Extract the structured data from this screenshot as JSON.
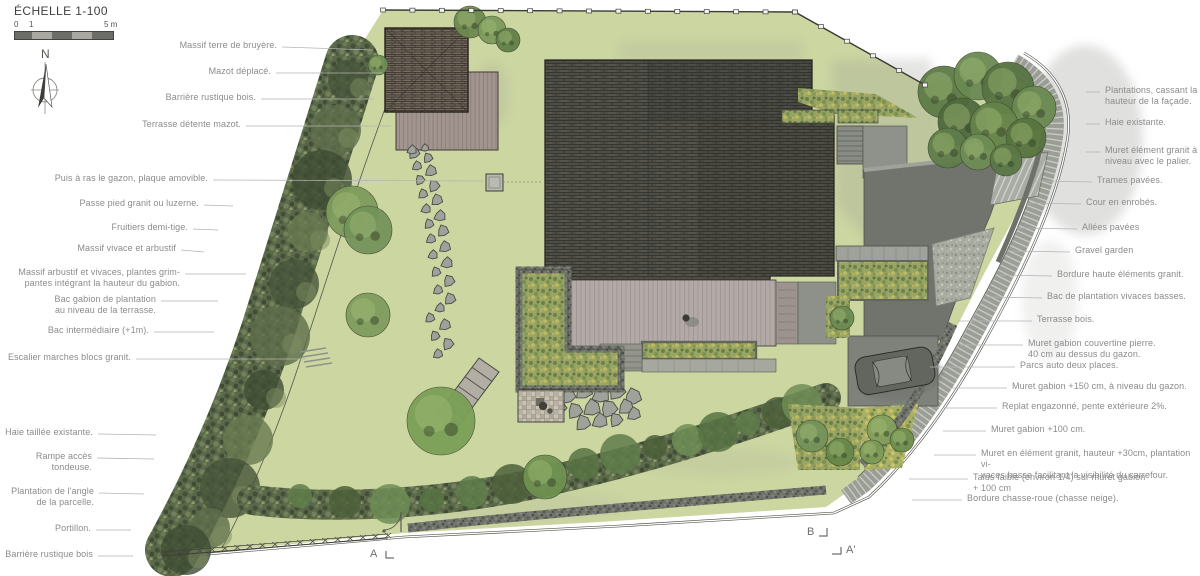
{
  "title_block": {
    "scale_label": "ÉCHELLE 1-100",
    "tick_0": "0",
    "tick_1": "1",
    "tick_5": "5 m",
    "north_label": "N"
  },
  "colors": {
    "lawn": "#ccd6a1",
    "hedge_green": "#5b684b",
    "roof_dark": "#4e4e47",
    "deck_wood": "#b3aaa8",
    "mazot_deck": "#a29590",
    "asphalt_court": "#70746d",
    "paving_gray": "#9b9e96",
    "gabion_gray": "#70746c",
    "label_text": "#8b8b8b",
    "leader_line": "#b3b3b3"
  },
  "annotations": {
    "left": [
      {
        "lines": [
          "Massif terre de bruyère."
        ],
        "x": 277,
        "y": 47,
        "tx": 373,
        "ty": 50
      },
      {
        "lines": [
          "Mazot déplacé."
        ],
        "x": 271,
        "y": 73,
        "tx": 382,
        "ty": 73
      },
      {
        "lines": [
          "Barrière rustique bois."
        ],
        "x": 256,
        "y": 99,
        "tx": 374,
        "ty": 99
      },
      {
        "lines": [
          "Terrasse détente mazot."
        ],
        "x": 241,
        "y": 126,
        "tx": 391,
        "ty": 126
      },
      {
        "lines": [
          "Puis à ras le gazon, plaque amovible."
        ],
        "x": 208,
        "y": 180,
        "tx": 483,
        "ty": 181
      },
      {
        "lines": [
          "Passe pied granit ou luzerne."
        ],
        "x": 199,
        "y": 205,
        "tx": 233,
        "ty": 206
      },
      {
        "lines": [
          "Fruitiers demi-tige."
        ],
        "x": 188,
        "y": 229,
        "tx": 218,
        "ty": 230
      },
      {
        "lines": [
          "Massif vivace et arbustif"
        ],
        "x": 176,
        "y": 250,
        "tx": 204,
        "ty": 252
      },
      {
        "lines": [
          "Massif arbustif et vivaces, plantes grim-",
          "pantes intégrant la hauteur du gabion."
        ],
        "x": 180,
        "y": 274,
        "tx": 246,
        "ty": 274
      },
      {
        "lines": [
          "Bac gabion de plantation",
          "au niveau de la terrasse."
        ],
        "x": 156,
        "y": 301,
        "tx": 218,
        "ty": 301
      },
      {
        "lines": [
          "Bac intermédiaire (+1m)."
        ],
        "x": 149,
        "y": 332,
        "tx": 214,
        "ty": 332
      },
      {
        "lines": [
          "Escalier marches blocs granit."
        ],
        "x": 131,
        "y": 359,
        "tx": 306,
        "ty": 359
      },
      {
        "lines": [
          "Haie taillée existante."
        ],
        "x": 93,
        "y": 434,
        "tx": 156,
        "ty": 435
      },
      {
        "lines": [
          "Rampe accès tondeuse."
        ],
        "x": 92,
        "y": 458,
        "tx": 154,
        "ty": 459
      },
      {
        "lines": [
          "Plantation de l'angle",
          "de la parcelle."
        ],
        "x": 94,
        "y": 493,
        "tx": 144,
        "ty": 494
      },
      {
        "lines": [
          "Portillon."
        ],
        "x": 91,
        "y": 530,
        "tx": 131,
        "ty": 530
      },
      {
        "lines": [
          "Barrière rustique bois"
        ],
        "x": 93,
        "y": 556,
        "tx": 133,
        "ty": 556
      }
    ],
    "right": [
      {
        "lines": [
          "Plantations, cassant la",
          "hauteur de la façade."
        ],
        "x": 1105,
        "y": 92,
        "tx": 1086,
        "ty": 92
      },
      {
        "lines": [
          "Haie existante."
        ],
        "x": 1105,
        "y": 124,
        "tx": 1086,
        "ty": 124
      },
      {
        "lines": [
          "Muret élément granit à",
          "niveau avec le palier."
        ],
        "x": 1105,
        "y": 152,
        "tx": 1086,
        "ty": 152
      },
      {
        "lines": [
          "Trames pavées."
        ],
        "x": 1097,
        "y": 182,
        "tx": 1036,
        "ty": 181
      },
      {
        "lines": [
          "Cour en enrobés."
        ],
        "x": 1086,
        "y": 204,
        "tx": 1026,
        "ty": 203
      },
      {
        "lines": [
          "Allées pavées"
        ],
        "x": 1082,
        "y": 229,
        "tx": 1017,
        "ty": 228
      },
      {
        "lines": [
          "Gravel garden"
        ],
        "x": 1075,
        "y": 252,
        "tx": 1007,
        "ty": 251
      },
      {
        "lines": [
          "Bordure haute éléments granit."
        ],
        "x": 1057,
        "y": 276,
        "tx": 997,
        "ty": 275
      },
      {
        "lines": [
          "Bac de plantation vivaces basses."
        ],
        "x": 1047,
        "y": 298,
        "tx": 987,
        "ty": 297
      },
      {
        "lines": [
          "Terrasse bois."
        ],
        "x": 1037,
        "y": 321,
        "tx": 958,
        "ty": 321
      },
      {
        "lines": [
          "Muret gabion couvertine pierre.",
          "40 cm au dessus du gazon."
        ],
        "x": 1028,
        "y": 345,
        "tx": 960,
        "ty": 345
      },
      {
        "lines": [
          "Parcs auto deux places."
        ],
        "x": 1020,
        "y": 367,
        "tx": 930,
        "ty": 367
      },
      {
        "lines": [
          "Muret gabion +150 cm, à niveau du gazon."
        ],
        "x": 1012,
        "y": 388,
        "tx": 952,
        "ty": 388
      },
      {
        "lines": [
          "Replat engazonné, pente extérieure 2%."
        ],
        "x": 1002,
        "y": 408,
        "tx": 944,
        "ty": 408
      },
      {
        "lines": [
          "Muret gabion +100 cm."
        ],
        "x": 991,
        "y": 431,
        "tx": 943,
        "ty": 431
      },
      {
        "lines": [
          "Muret en élément granit, hauteur +30cm, plantation vi-",
          "vaces basse facilitant la visibilité du carrefour."
        ],
        "x": 981,
        "y": 455,
        "tx": 934,
        "ty": 455
      },
      {
        "lines": [
          "Talus faible (environ 1/4) sur muret gabion",
          "+ 100 cm"
        ],
        "x": 973,
        "y": 479,
        "tx": 909,
        "ty": 479
      },
      {
        "lines": [
          "Bordure chasse-roue (chasse neige)."
        ],
        "x": 967,
        "y": 500,
        "tx": 912,
        "ty": 500
      }
    ]
  },
  "section_markers": [
    {
      "label": "A",
      "x": 375,
      "y": 555,
      "bracket": "right-up"
    },
    {
      "label": "B",
      "x": 812,
      "y": 533,
      "bracket": "right-down"
    },
    {
      "label": "A'",
      "x": 851,
      "y": 551,
      "bracket": "left-before"
    }
  ]
}
